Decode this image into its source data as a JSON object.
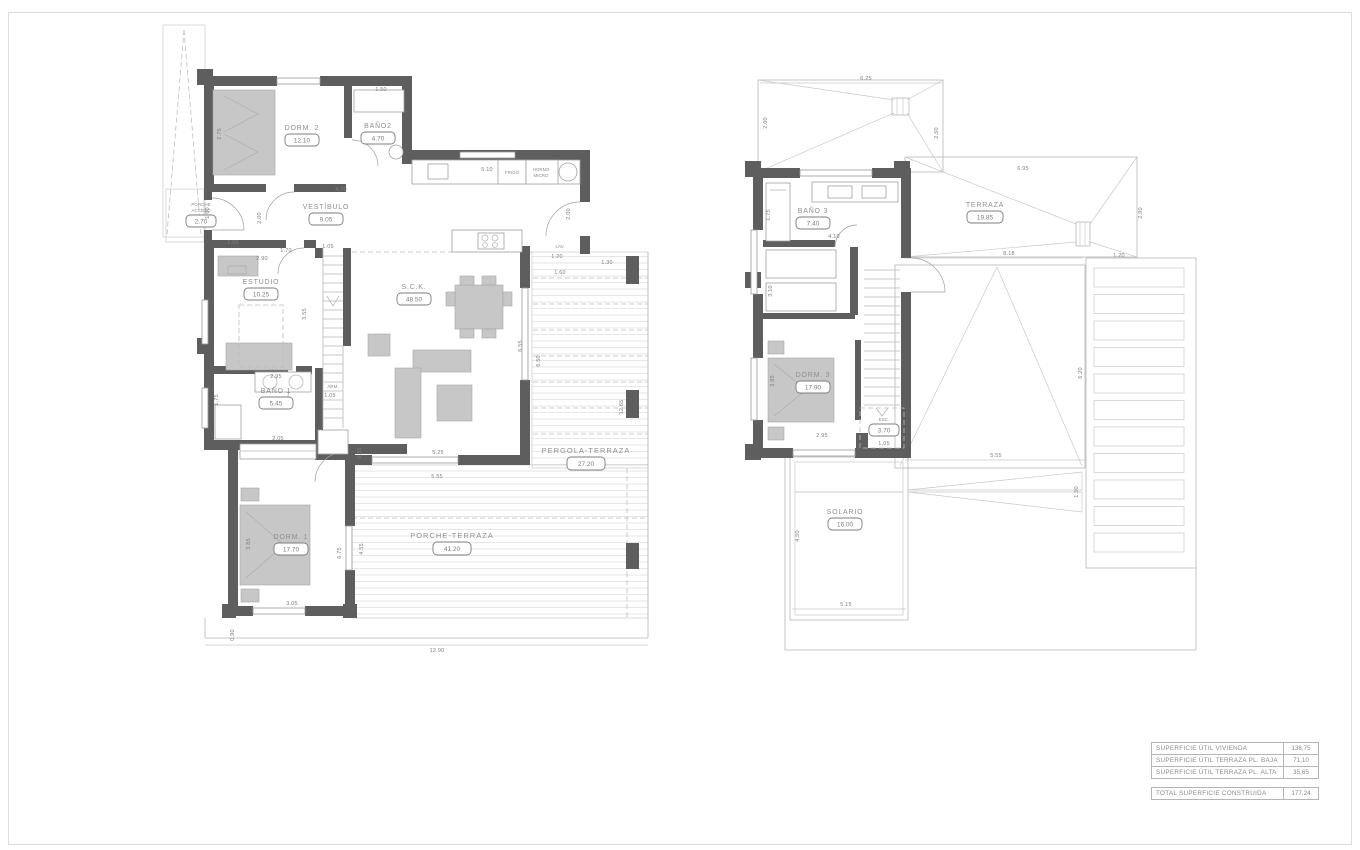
{
  "colors": {
    "wall": "#5e5e5e",
    "furniture": "#c7c7c7",
    "deck_line": "#e0e0e0",
    "label_text": "#8f8f8f",
    "dim_text": "#7f7f7f"
  },
  "ground_floor": {
    "rooms": [
      {
        "name": "DORM. 2",
        "area": "12.10"
      },
      {
        "name": "BAÑO2",
        "area": "4.70"
      },
      {
        "name": "PORCHE",
        "name2": "ACCESO",
        "area": "2.70"
      },
      {
        "name": "VESTÍBULO",
        "area": "9.05"
      },
      {
        "name": "ESTUDIO",
        "area": "10.25"
      },
      {
        "name": "S.C.K.",
        "area": "48.50"
      },
      {
        "name": "BAÑO 1",
        "area": "5.45"
      },
      {
        "name": "ARM."
      },
      {
        "name": "DORM. 1",
        "area": "17.70"
      },
      {
        "name": "PORCHE-TERRAZA",
        "area": "41.20"
      },
      {
        "name": "PERGOLA-TERRAZA",
        "area": "27.20"
      }
    ],
    "appliances": {
      "frigo": "FRIGO",
      "horno": "HORNO",
      "micro": "MICRO",
      "lav": "LAV."
    },
    "dims": [
      "1.50",
      "5.10",
      "4.70",
      "2.75",
      "1.60",
      "2.00",
      "1.55",
      "1.70",
      "2.90",
      "1.05",
      "3.55",
      "2.95",
      "1.75",
      "1.05",
      "2.05",
      "0.35",
      "5.25",
      "5.55",
      "3.85",
      "6.75",
      "4.55",
      "3.05",
      "0.90",
      "12.90",
      "1.30",
      "1.60",
      "1.20",
      "2.00",
      "6.55",
      "6.50",
      "12.65"
    ]
  },
  "first_floor": {
    "rooms": [
      {
        "name": "BAÑO 3",
        "area": "7.40"
      },
      {
        "name": "TERRAZA",
        "area": "19.85"
      },
      {
        "name": "DORM. 3",
        "area": "17.90"
      },
      {
        "name": "ESC.",
        "area": "3.70"
      },
      {
        "name": "SOLARIO",
        "area": "16.00"
      }
    ],
    "dims": [
      "6.25",
      "2.00",
      "2.50",
      "6.95",
      "2.90",
      "8.18",
      "1.20",
      "1.75",
      "4.10",
      "3.10",
      "3.85",
      "2.95",
      "1.05",
      "5.55",
      "6.20",
      "1.50",
      "4.50",
      "5.15"
    ]
  },
  "summary_table": {
    "rows": [
      {
        "label": "SUPERFICIE ÚTIL VIVIENDA",
        "value": "138,75"
      },
      {
        "label": "SUPERFICIE ÚTIL TERRAZA PL. BAJA",
        "value": "71,10"
      },
      {
        "label": "SUPERFICIE ÚTIL TERRAZA PL. ALTA",
        "value": "35,65"
      }
    ],
    "total": {
      "label": "TOTAL SUPERFICIE CONSTRUIDA",
      "value": "177,24"
    }
  }
}
